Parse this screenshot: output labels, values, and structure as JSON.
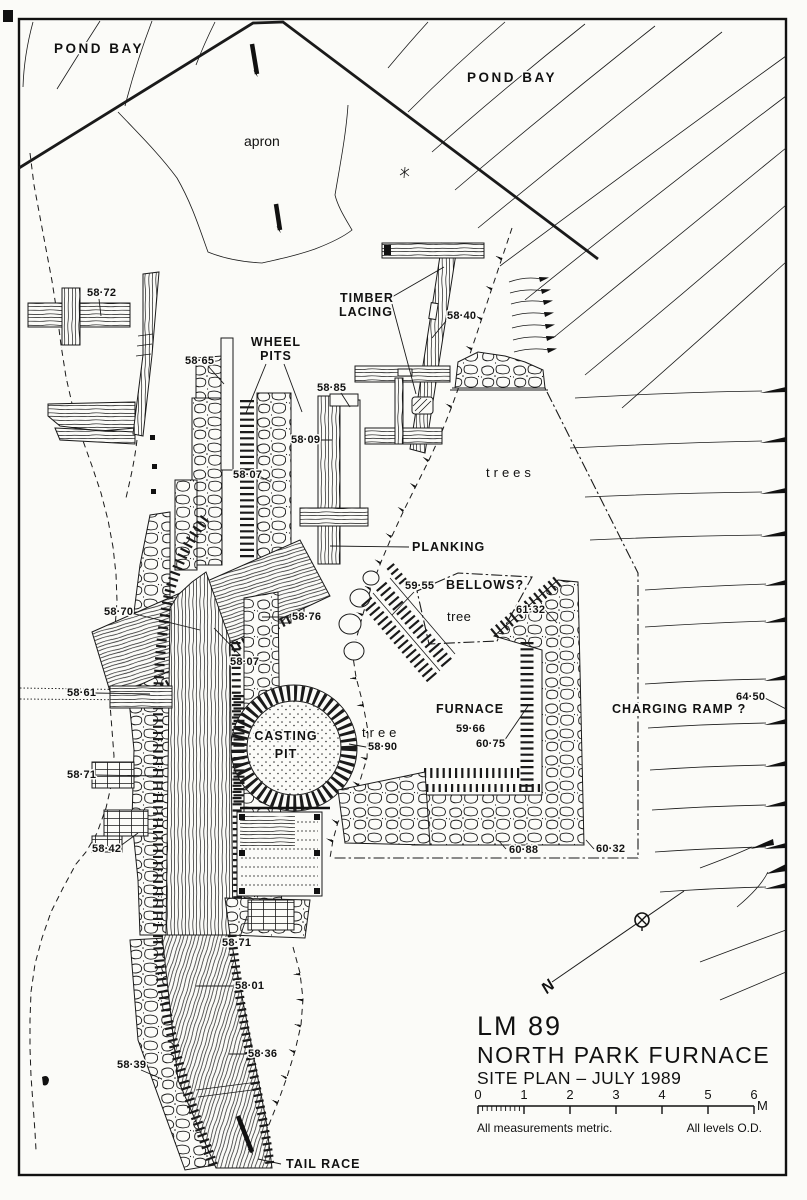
{
  "drawing": {
    "areas": {
      "pond_bay_left": "POND BAY",
      "pond_bay_right": "POND BAY",
      "apron": "apron",
      "trees": "trees",
      "tree_bellows": "tree",
      "tree_casting": "tree"
    },
    "features": {
      "wheel_pits_1": "WHEEL",
      "wheel_pits_2": "PITS",
      "timber_lacing_1": "TIMBER",
      "timber_lacing_2": "LACING",
      "planking": "PLANKING",
      "bellows": "BELLOWS?",
      "furnace": "FURNACE",
      "casting_pit_1": "CASTING",
      "casting_pit_2": "PIT",
      "charging_ramp": "CHARGING RAMP ?",
      "tail_race": "TAIL RACE"
    },
    "elevations": [
      {
        "value": "58·72"
      },
      {
        "value": "58·65"
      },
      {
        "value": "58·40"
      },
      {
        "value": "58·85"
      },
      {
        "value": "58·09"
      },
      {
        "value": "58·07"
      },
      {
        "value": "58·76"
      },
      {
        "value": "58·07"
      },
      {
        "value": "58·70"
      },
      {
        "value": "58·61"
      },
      {
        "value": "59·55"
      },
      {
        "value": "61·32"
      },
      {
        "value": "59·66"
      },
      {
        "value": "60·75"
      },
      {
        "value": "64·50"
      },
      {
        "value": "58·90"
      },
      {
        "value": "58·71"
      },
      {
        "value": "58·42"
      },
      {
        "value": "60·88"
      },
      {
        "value": "60·32"
      },
      {
        "value": "58·71"
      },
      {
        "value": "58·01"
      },
      {
        "value": "58·36"
      },
      {
        "value": "58·39"
      }
    ],
    "compass": {
      "north_label": "N"
    },
    "title_block": {
      "site_code": "LM 89",
      "site_name": "NORTH PARK FURNACE",
      "subtitle": "SITE PLAN – JULY 1989",
      "scale_bar": {
        "ticks": [
          "0",
          "1",
          "2",
          "3",
          "4",
          "5",
          "6"
        ],
        "unit": "M"
      },
      "note_left": "All measurements metric.",
      "note_right": "All levels O.D."
    }
  }
}
